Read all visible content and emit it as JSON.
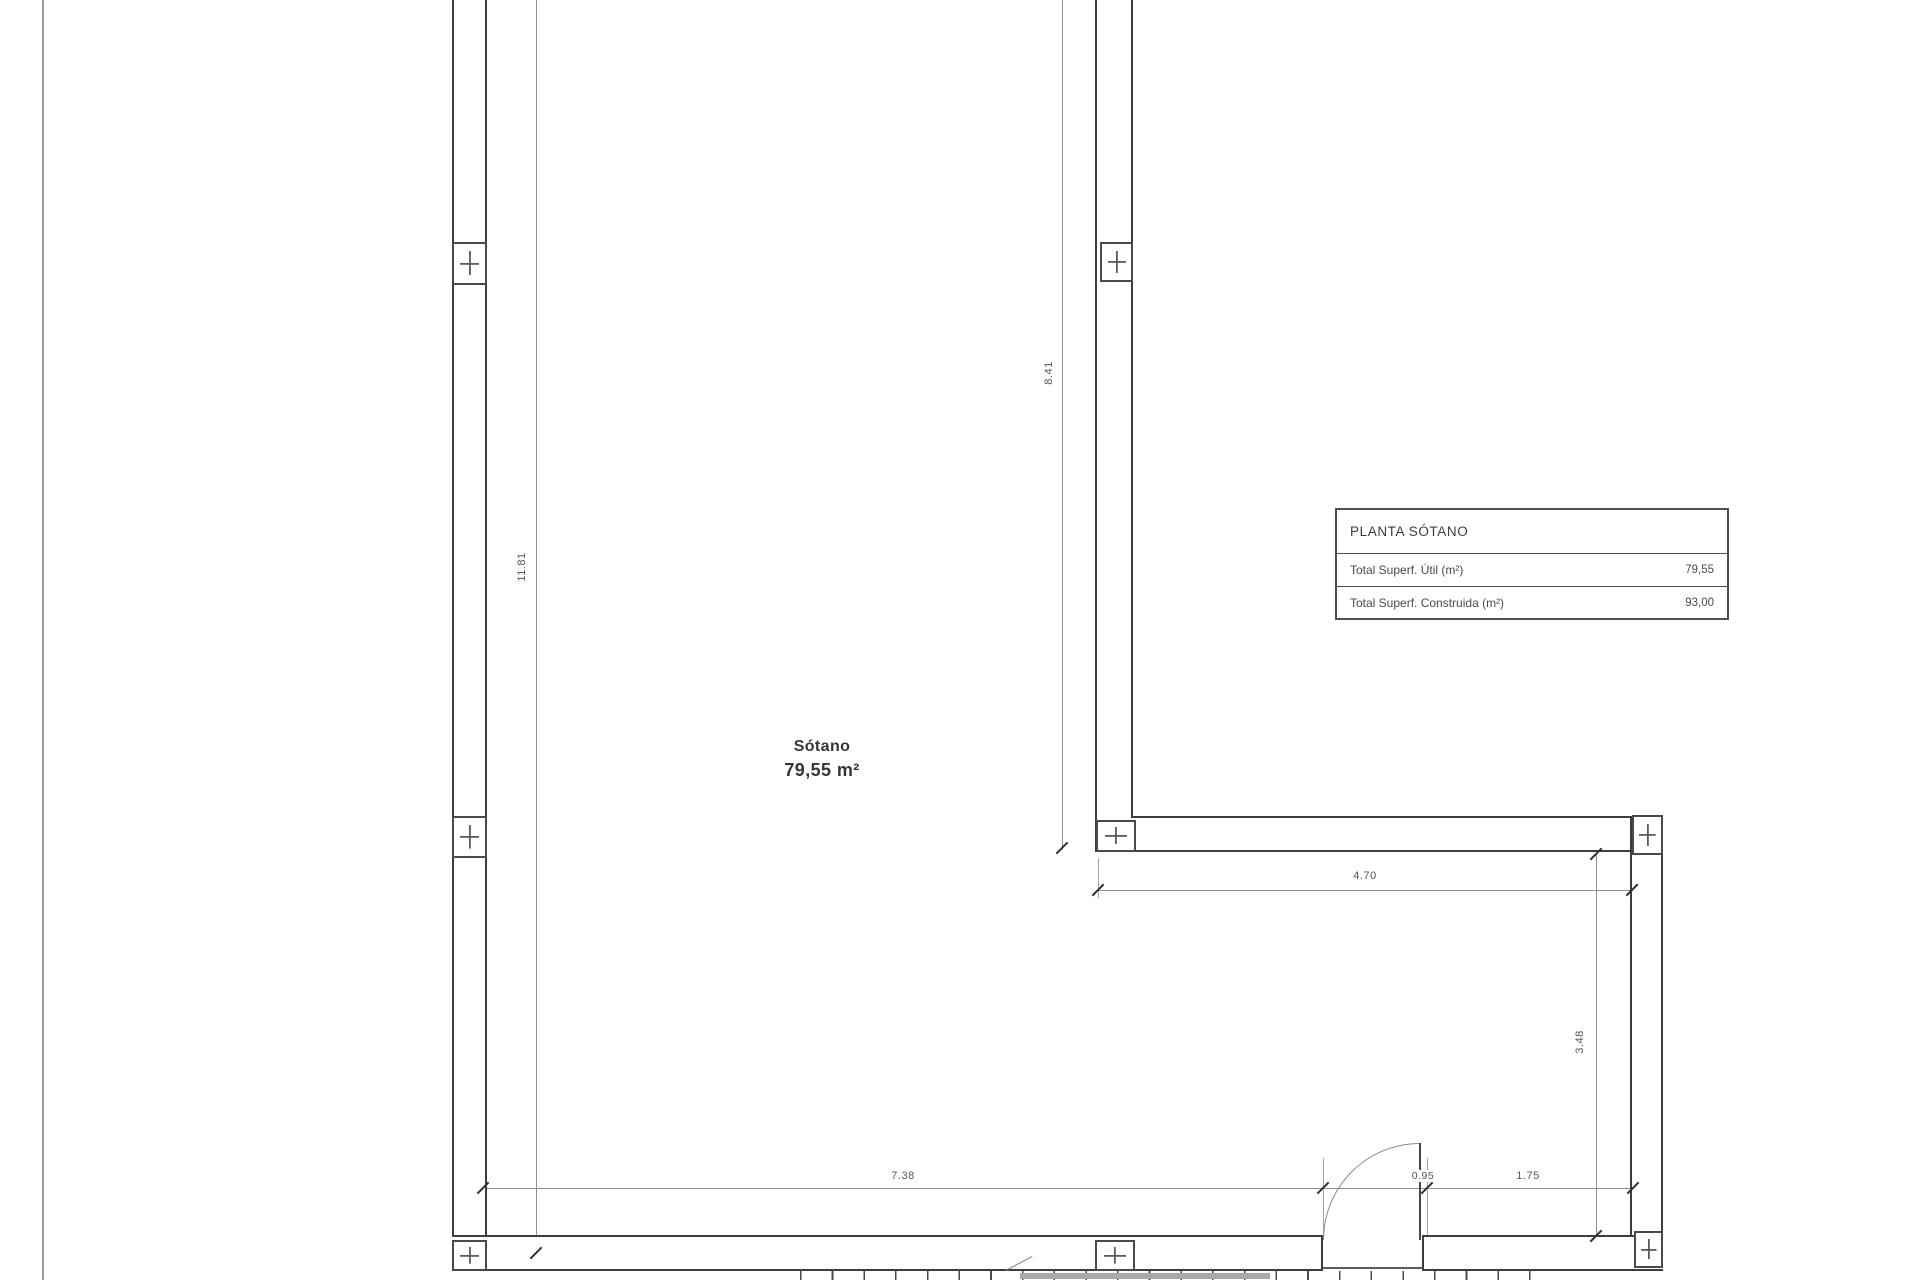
{
  "drawing": {
    "room": {
      "name": "Sótano",
      "area": "79,55 m²"
    },
    "dimensions": {
      "left_height": "11.81",
      "mid_height": "8.41",
      "top_width": "4.70",
      "right_height": "3.48",
      "bottom_left": "7.38",
      "door_width": "0.95",
      "bottom_right": "1.75"
    },
    "summary_table": {
      "title": "PLANTA SÓTANO",
      "rows": [
        {
          "label": "Total Superf. Útil (m²)",
          "value": "79,55"
        },
        {
          "label": "Total Superf. Construida (m²)",
          "value": "93,00"
        }
      ]
    },
    "colors": {
      "wall_line": "#3d3d3d",
      "dim_line": "#8f8f8f",
      "text": "#4a4a4a"
    }
  }
}
